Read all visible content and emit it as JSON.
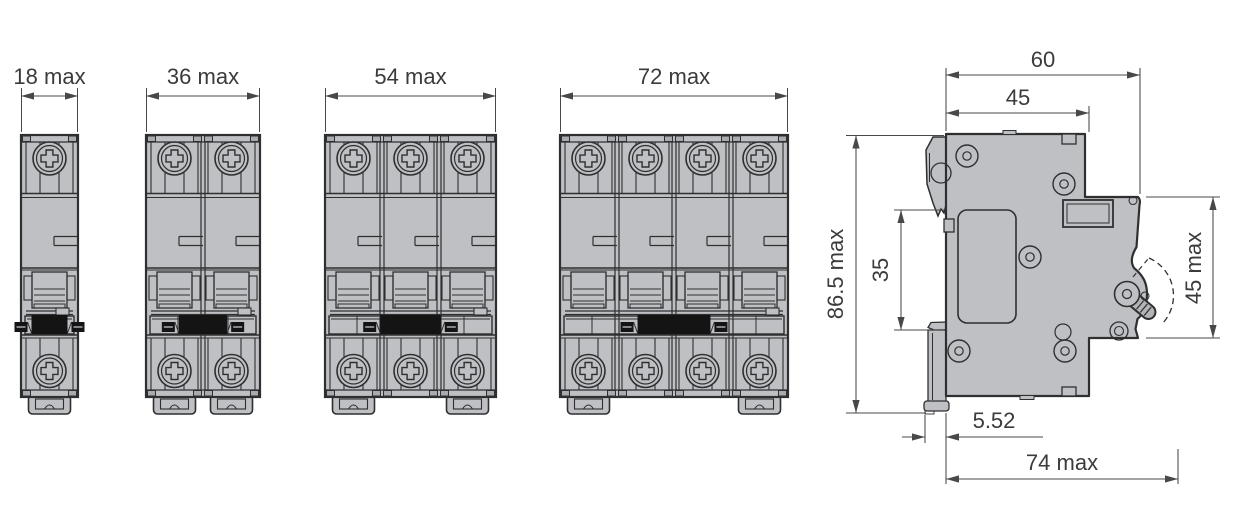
{
  "figures": {
    "front_views": [
      {
        "poles": 1,
        "dim_label": "18 max"
      },
      {
        "poles": 2,
        "dim_label": "36 max"
      },
      {
        "poles": 3,
        "dim_label": "54 max"
      },
      {
        "poles": 4,
        "dim_label": "72 max"
      }
    ],
    "side_view": {
      "dims": {
        "overall_depth_top": "60",
        "upper_body_depth": "45",
        "overall_height": "86.5 max",
        "din_rail_slot": "35",
        "front_face_height": "45 max",
        "clip_projection": "5.52",
        "max_depth": "74 max"
      }
    }
  },
  "colors": {
    "body": "#bfc0c3",
    "tab": "#a9abae",
    "line": "#2e2f31",
    "dim_line": "#47484a",
    "text": "#3b3b3d",
    "toggle": "#141415",
    "handle": "#b3b4b7",
    "background": "#ffffff"
  }
}
